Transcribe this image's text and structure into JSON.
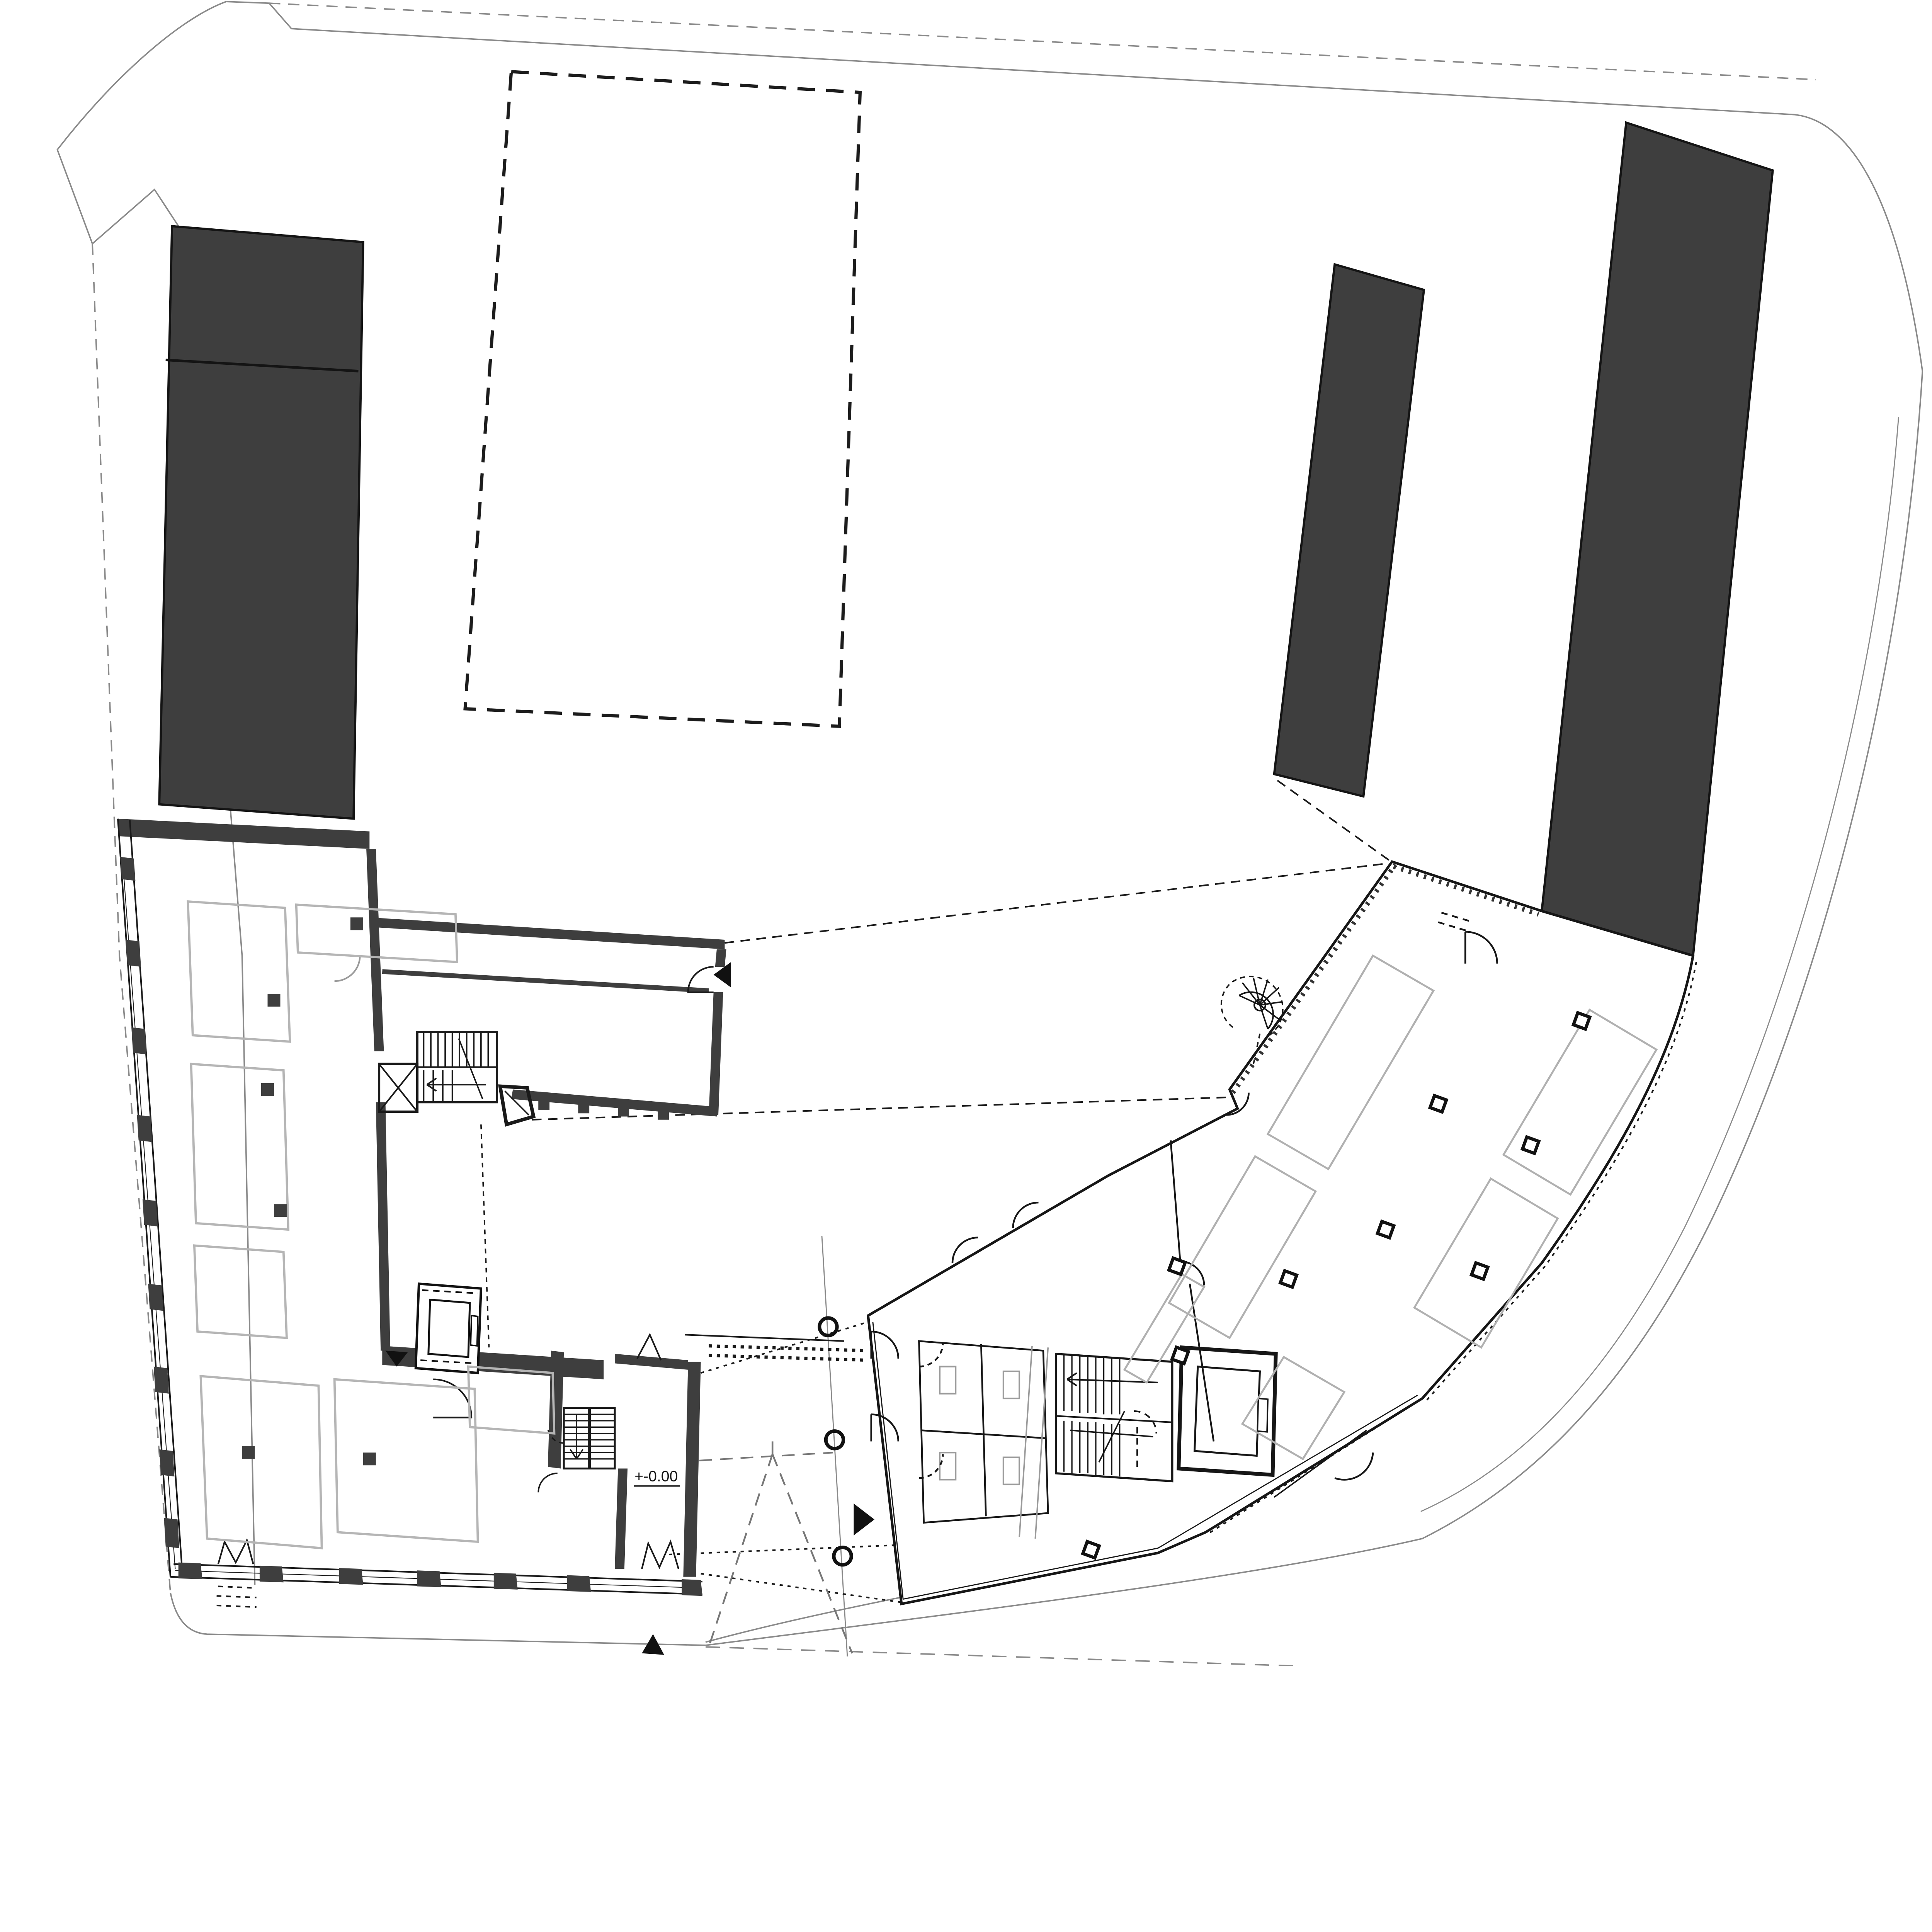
{
  "drawing": {
    "kind": "architectural site and ground-floor plan",
    "annotations": {
      "level_label": "+-0.00"
    },
    "colors": {
      "background": "#ffffff",
      "building_mass_fill": "#3e3e3e",
      "wall_line_black": "#1a1a1a",
      "site_boundary_gray": "#8a8a8a",
      "room_outline_gray": "#b5b5b5",
      "fixture_gray": "#9a9a9a"
    },
    "symbols": {
      "entrance_markers": [
        {
          "name": "courtyard-entrance-marker",
          "direction": "down"
        },
        {
          "name": "annex-entrance-marker",
          "direction": "left"
        },
        {
          "name": "new-building-entrance-marker",
          "direction": "right"
        },
        {
          "name": "south-entrance-marker",
          "direction": "up"
        }
      ],
      "skylight_squares_count": 9,
      "bollard_circles_count": 3,
      "stair_cores_count": 4,
      "spiral_stair_count": 1
    }
  }
}
